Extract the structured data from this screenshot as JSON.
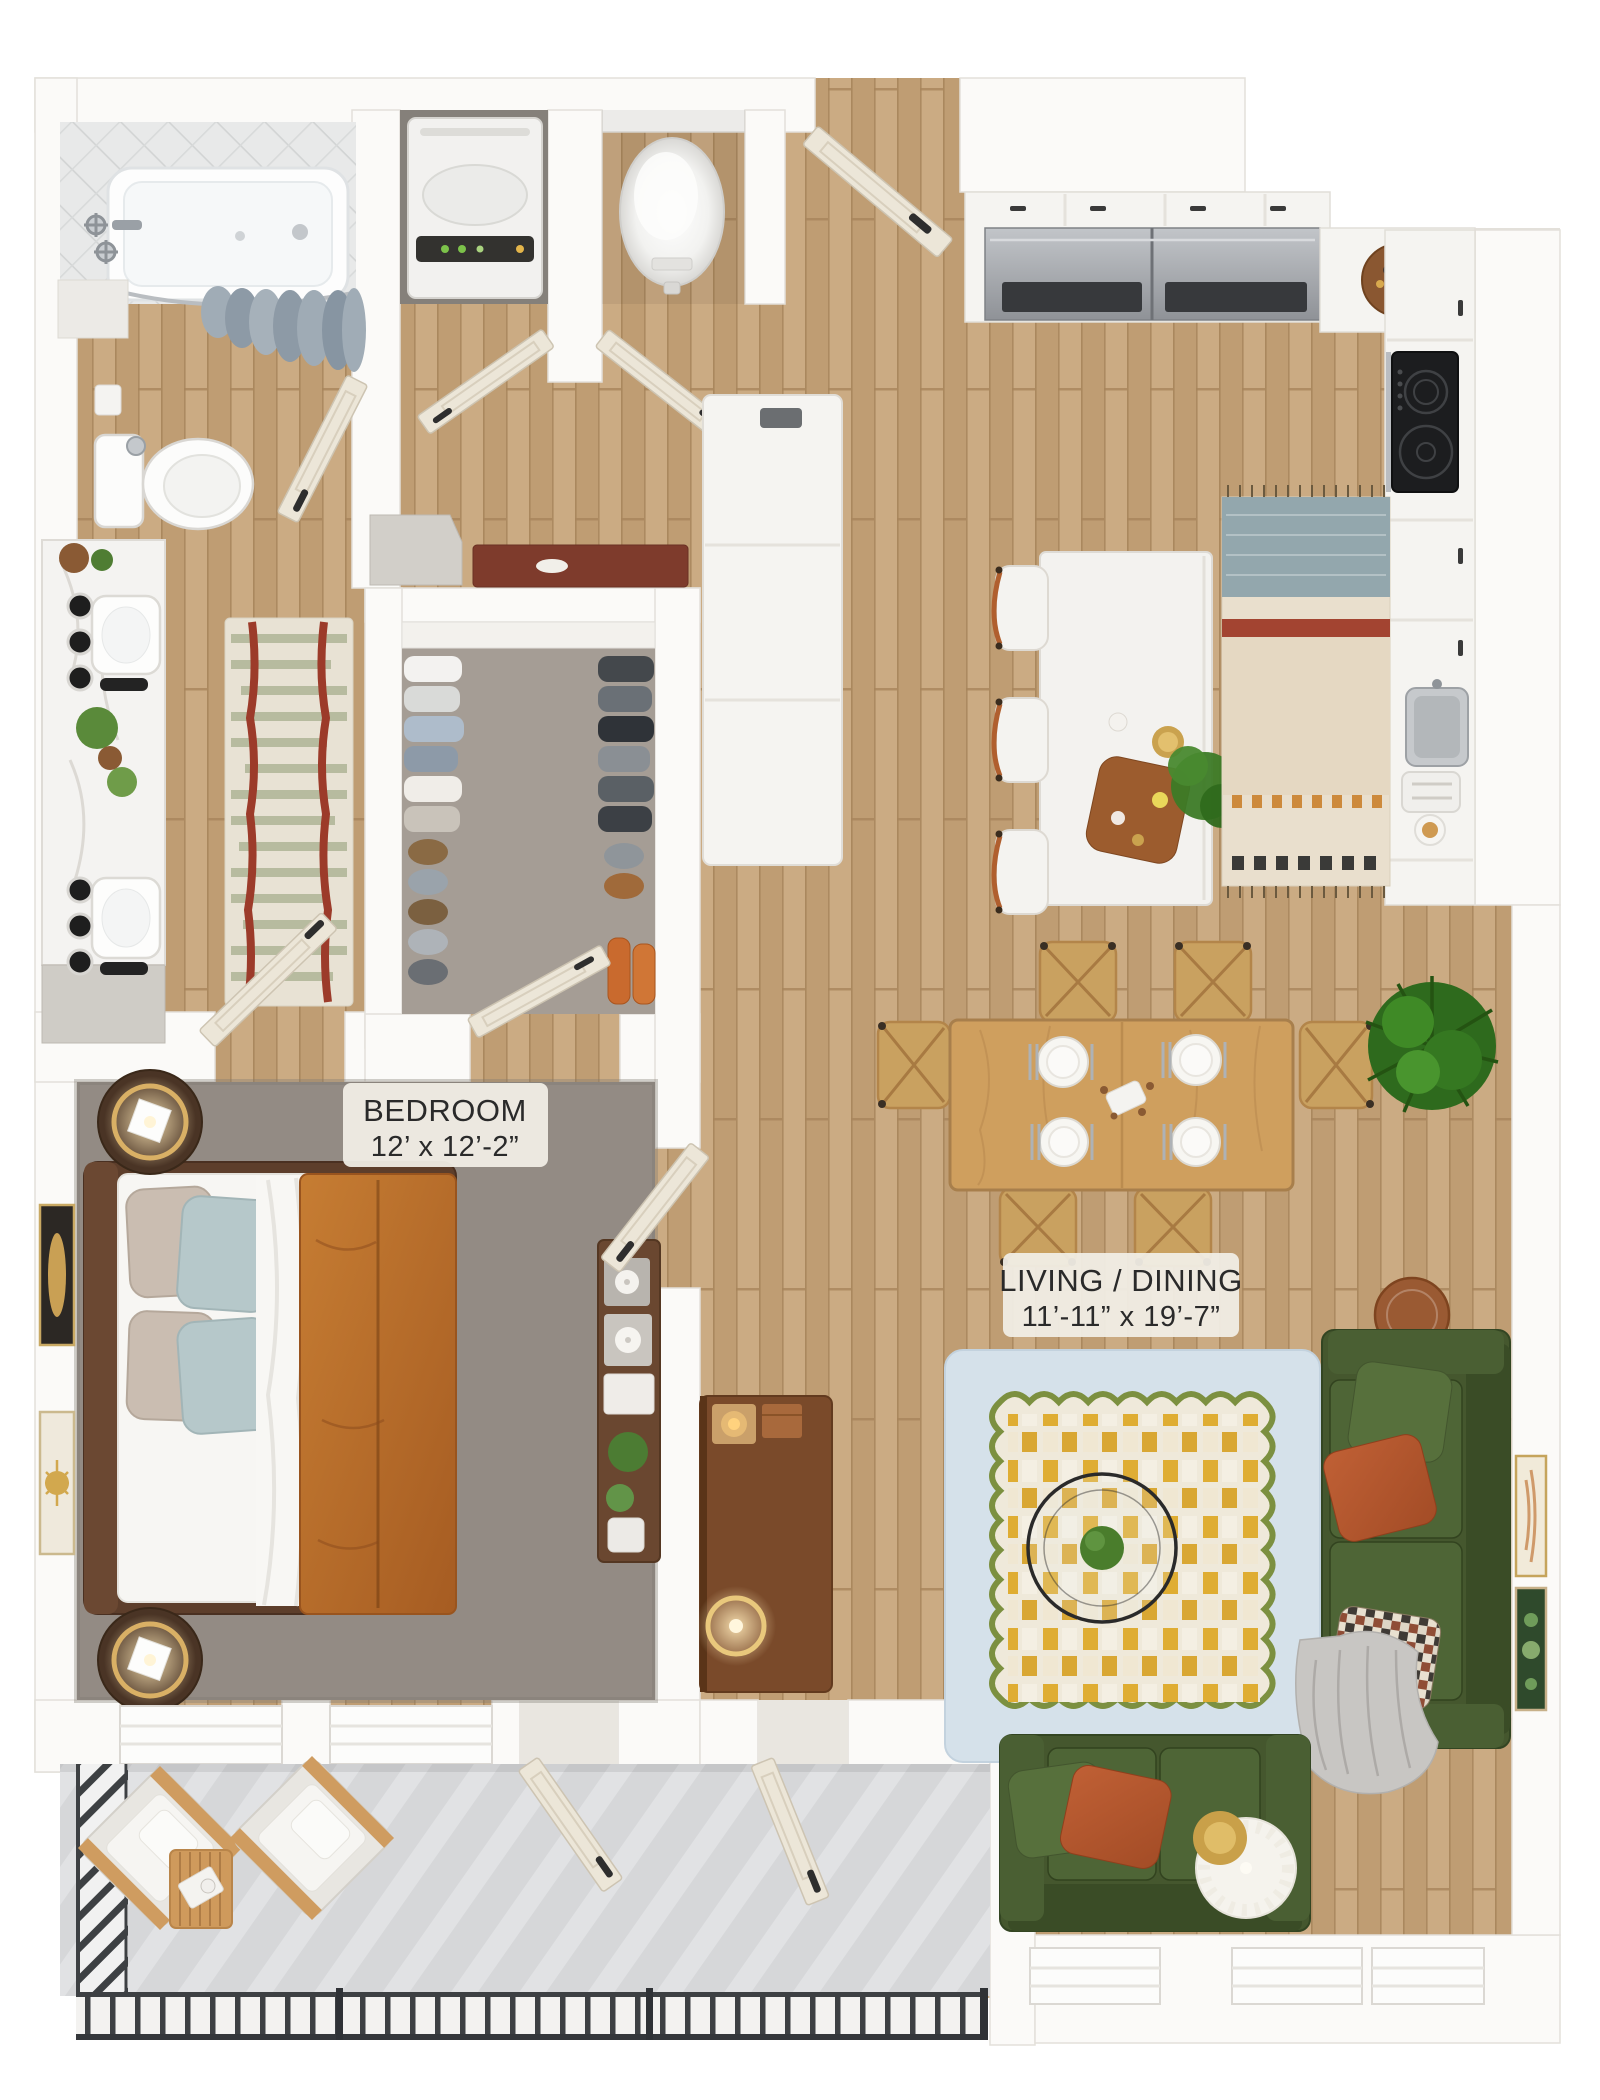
{
  "floor_plan": {
    "title": "One-bedroom apartment 3D floor plan",
    "rooms": {
      "bedroom": {
        "name": "BEDROOM",
        "dimensions": "12’ x 12’-2”"
      },
      "living_dining": {
        "name": "LIVING / DINING",
        "dimensions": "11’-11” x 19’-7”"
      }
    },
    "unlabeled_areas": [
      "bathroom",
      "walk-in closet",
      "kitchen",
      "entry foyer",
      "laundry closet",
      "water-heater closet",
      "balcony"
    ],
    "colors": {
      "wood_floor": "#c5a47c",
      "bedroom_carpet": "#938b84",
      "closet_carpet": "#a59d95",
      "balcony_concrete": "#d6d7d9",
      "wall": "#fbfaf8",
      "sofa_green": "#45572e",
      "rug_border_blue": "#d5e1ea",
      "rug_yellow": "#dfad33",
      "rug_scallop_green": "#7c9040",
      "duvet_rust": "#c67d33",
      "pillow_rust": "#b4552e",
      "runner_blue": "#93a7ad",
      "runner_red": "#a34431",
      "bath_rug_stripe": "#b7bb9f",
      "bath_rug_red": "#9c3b2a",
      "railing_black": "#3d4043",
      "lamp_gold": "#c9a049"
    }
  }
}
